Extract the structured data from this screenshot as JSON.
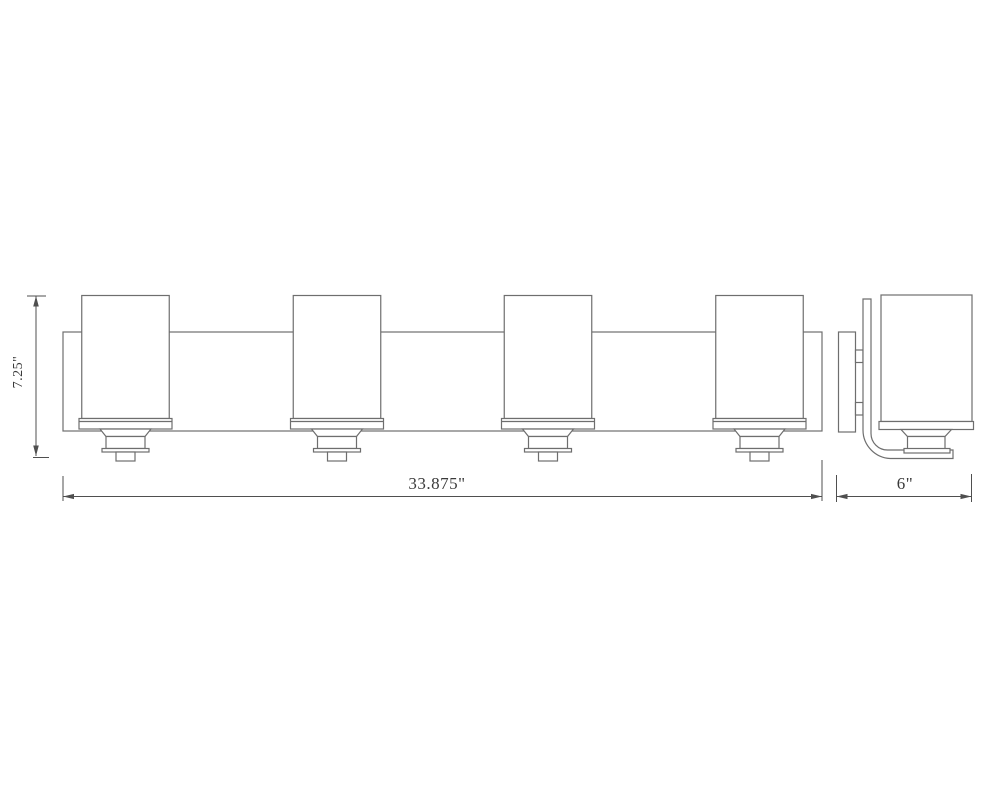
{
  "drawing": {
    "dimension_labels": {
      "height": "7.25\"",
      "width": "33.875\"",
      "depth": "6\""
    },
    "colors": {
      "background": "#ffffff",
      "line": "#6e6e6e",
      "dimension": "#4f4f4f",
      "text": "#3a3a3a"
    },
    "views": {
      "front": {
        "light_count": 4
      },
      "side": {
        "light_count": 1,
        "mounting_tab_count": 2
      }
    }
  }
}
